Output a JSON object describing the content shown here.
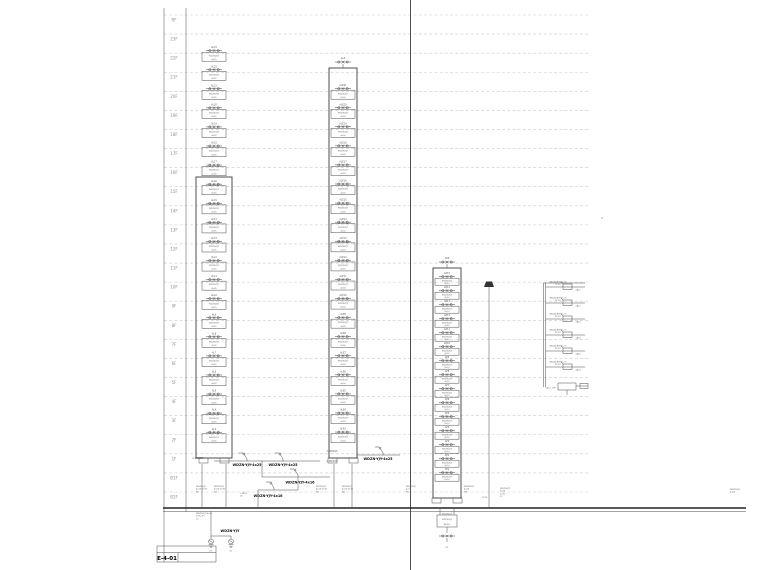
{
  "meta": {
    "drawing_type": "electrical-riser-diagram",
    "line_color": "#3c3c3c",
    "grid_color": "#c9c9c9",
    "ground_y": 508
  },
  "floors": {
    "labels": [
      "RF",
      "23F",
      "22F",
      "21F",
      "20F",
      "19F",
      "18F",
      "17F",
      "16F",
      "15F",
      "14F",
      "13F",
      "12F",
      "11F",
      "10F",
      "9F",
      "8F",
      "7F",
      "6F",
      "5F",
      "4F",
      "3F",
      "2F",
      "1F",
      "B1F",
      "B2F"
    ]
  },
  "title_block": {
    "text": "E-4-01"
  },
  "risers": [
    {
      "id": "riser-1",
      "cx": 214,
      "first_y": 46,
      "pitch": 19.08,
      "count": 21,
      "outer": [
        196,
        177,
        232,
        458
      ],
      "feet_y": 458,
      "head_label": "",
      "unit_prefix": "AL",
      "unit_cable": "WDZN-YJY",
      "unit_spec": "4x25",
      "floors_top_to_bottom": [
        "23",
        "22",
        "21",
        "20",
        "19",
        "18",
        "17",
        "16",
        "15",
        "14",
        "13",
        "12",
        "11",
        "10",
        "9",
        "8",
        "7",
        "6",
        "5",
        "4",
        "3"
      ]
    },
    {
      "id": "riser-2",
      "cx": 343,
      "first_y": 84,
      "pitch": 19.08,
      "count": 19,
      "outer": [
        329,
        68,
        357,
        458
      ],
      "feet_y": 458,
      "head_label": "ALZ",
      "unit_prefix": "ALE",
      "unit_cable": "WDZN-YJY",
      "unit_spec": "4x16",
      "floors_top_to_bottom": [
        "21",
        "20",
        "19",
        "18",
        "17",
        "16",
        "15",
        "14",
        "13",
        "12",
        "11",
        "10",
        "9",
        "8",
        "7",
        "6",
        "5",
        "4",
        "3"
      ]
    },
    {
      "id": "riser-3",
      "cx": 447,
      "first_y": 272,
      "pitch": 14,
      "count": 15,
      "outer": [
        433,
        268,
        461,
        498
      ],
      "feet_y": 498,
      "head_label": "APZ",
      "unit_prefix": "AP",
      "unit_cable": "WDZN-YJY",
      "unit_spec": "4x10",
      "floors_top_to_bottom": [
        "15",
        "14",
        "13",
        "12",
        "11",
        "10",
        "9",
        "8",
        "7",
        "6",
        "5",
        "4",
        "3",
        "2",
        "1"
      ]
    }
  ],
  "detail": {
    "source_label": "1AL-1 (2F)",
    "branch_spec": "WDZN-BYJ-3x2.5",
    "branch_spec2": "PC20",
    "branches": [
      {
        "tag": "1AL1"
      },
      {
        "tag": "1AL2"
      },
      {
        "tag": "1AL3"
      },
      {
        "tag": "1AL4"
      },
      {
        "tag": "1AL5"
      },
      {
        "tag": "1AL6"
      }
    ]
  },
  "feeder_labels": {
    "bold_a": "WDZN-YJY-4x25",
    "bold_b": "WDZN-YJY-4x25",
    "bold_c": "WDZN-YJY-4x25",
    "bold_d": "WDZN-YJY-4x16",
    "bold_e": "WDZN-YJY-4x16",
    "bold_f": "WDZN-YJY",
    "wire_note_1": "C-WDZ25",
    "wire_note_2": "C-WDZ25",
    "wire_note_3": "C-WDZ25"
  },
  "label_blocks": [
    {
      "x": 196,
      "y": 487,
      "lines": [
        "WDZN-YJY",
        "4x25-SC32",
        "N1"
      ]
    },
    {
      "x": 214,
      "y": 487,
      "lines": [
        "WDZN-YJY",
        "4x25-SC32",
        "N2"
      ]
    },
    {
      "x": 316,
      "y": 487,
      "lines": [
        "WDZN-YJY",
        "4x25-SC32",
        "N3"
      ]
    },
    {
      "x": 342,
      "y": 487,
      "lines": [
        "WDZN-YJY",
        "4x25-SC32",
        "N4"
      ]
    },
    {
      "x": 406,
      "y": 487,
      "lines": [
        "WDZN-YJY",
        "4x25",
        "N5"
      ]
    },
    {
      "x": 464,
      "y": 487,
      "lines": [
        "WDZN-YJY",
        "4x25",
        "N6"
      ]
    },
    {
      "x": 500,
      "y": 489,
      "lines": [
        "WDZN-YJY",
        "4x25",
        "SC32",
        "FC"
      ]
    },
    {
      "x": 730,
      "y": 490,
      "lines": [
        "WDZN-YJY",
        "4x25"
      ]
    },
    {
      "x": 482,
      "y": 498,
      "lines": [
        "SC25"
      ]
    },
    {
      "x": 196,
      "y": 514,
      "lines": [
        "WDZN-YJY-4x25",
        "SC32-FC",
        "x2"
      ]
    },
    {
      "x": 240,
      "y": 494,
      "lines": [
        "C-WDZ",
        "25"
      ]
    }
  ],
  "underground": {
    "box_lines": [
      "WDZN-YJY",
      "AP-B2"
    ],
    "box_top_label": "WDZN-YJY",
    "earth_label_1": "E1",
    "earth_label_2": "E2",
    "earth_label_3": "E3",
    "bold_label": "WDZN-YJY"
  },
  "misc": {
    "mark_right": "1"
  }
}
